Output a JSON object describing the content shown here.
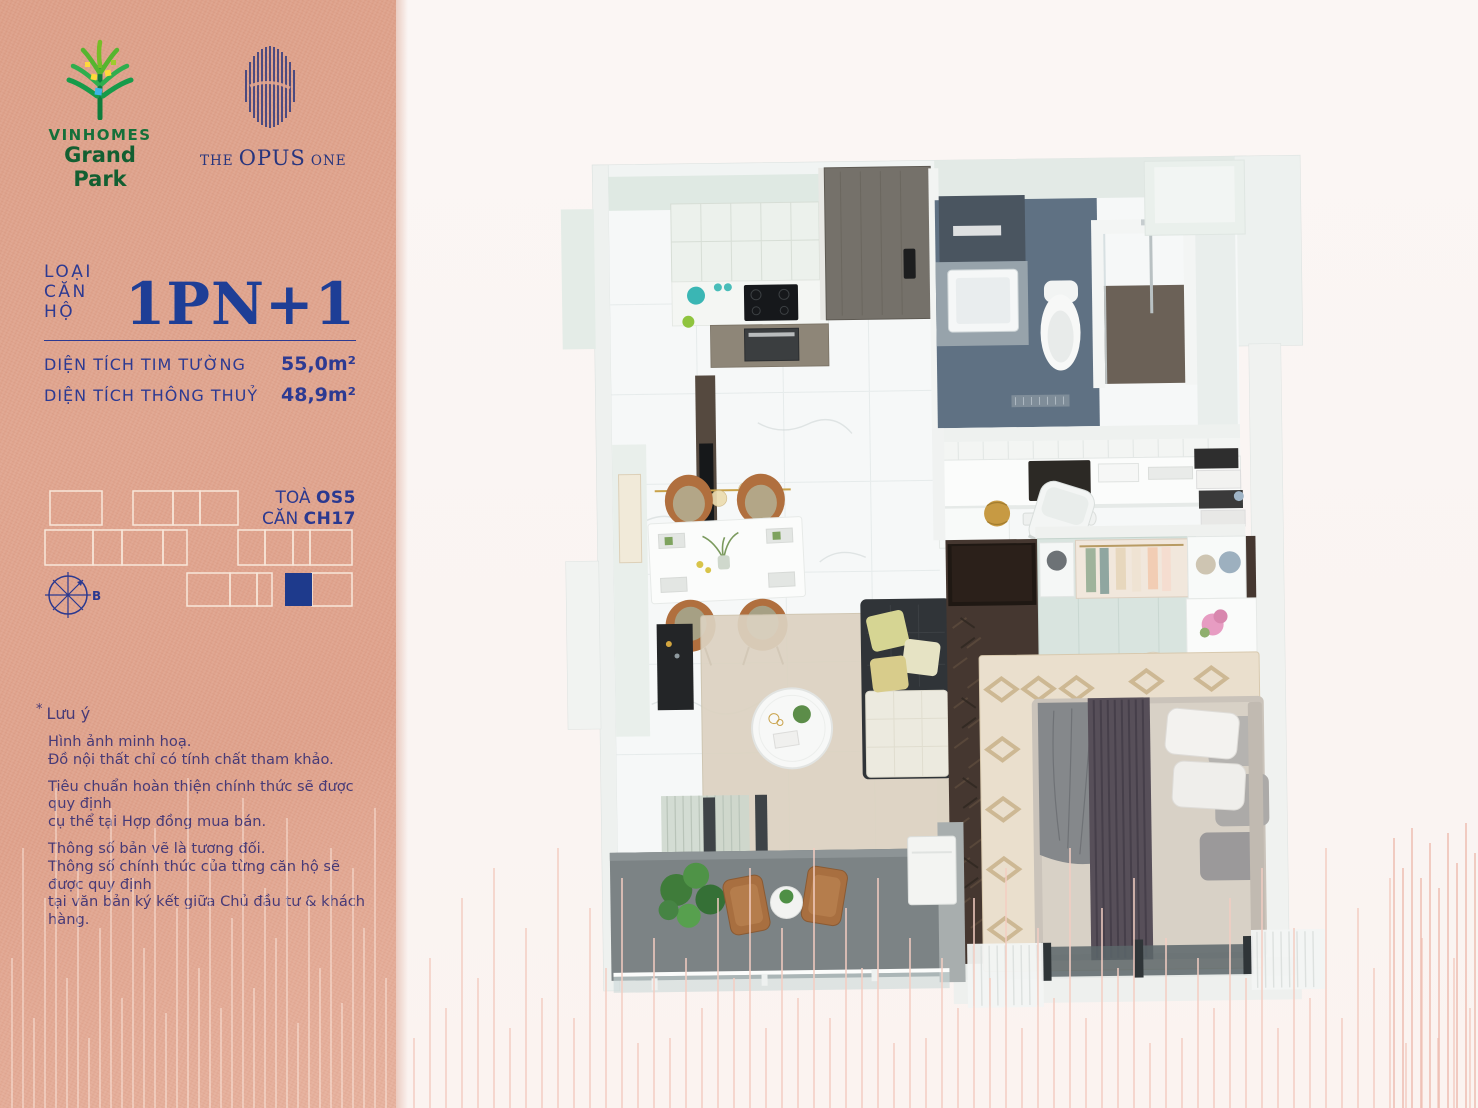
{
  "brand": {
    "vinhomes": {
      "line1": "VINHOMES",
      "line2": "Grand Park"
    },
    "opus": {
      "the": "THE",
      "word": "OPUS",
      "one": "ONE"
    }
  },
  "unit": {
    "type_label": "LOẠI CĂN HỘ",
    "type_value": "1PN+1",
    "areas": [
      {
        "label": "DIỆN TÍCH TIM TƯỜNG",
        "value": "55,0m²"
      },
      {
        "label": "DIỆN TÍCH THÔNG THUỶ",
        "value": "48,9m²"
      }
    ],
    "tower_label": "TOÀ",
    "tower_value": "OS5",
    "unit_label": "CĂN",
    "unit_value": "CH17",
    "compass_label": "B"
  },
  "notes": {
    "star": "*",
    "title": "Lưu ý",
    "paragraphs": [
      "Hình ảnh minh hoạ.\nĐồ nội thất chỉ có tính chất tham khảo.",
      "Tiêu chuẩn hoàn thiện chính thức sẽ được quy định\ncụ thể tại Hợp đồng mua bán.",
      "Thông số bản vẽ là tương đối.\nThông số chính thức của từng căn hộ sẽ được quy định\ntại văn bản ký kết giữa Chủ đầu tư & khách hàng."
    ]
  },
  "colors": {
    "sidebar_salmon": "#e0a48e",
    "accent_navy": "#2d3a92",
    "headline_navy": "#1e3e96",
    "note_purple": "#473a77",
    "keyplan_outline": "#f8e7da",
    "keyplan_fill": "#1e3a8c",
    "logo_green": "#15703a",
    "opus_navy": "#27357e",
    "deco_line_pink": "#f3cdc2",
    "bathroom_slate": "#5f7183",
    "bedroom_wood": "#453730"
  }
}
